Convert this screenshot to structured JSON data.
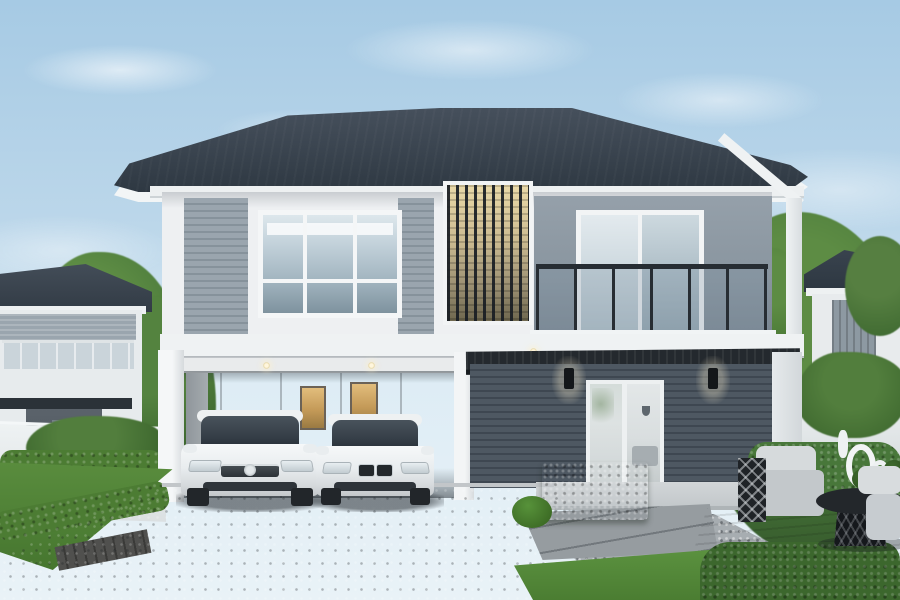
{
  "scene": {
    "type": "architectural-exterior-render",
    "description": "Daytime 3D rendering of a modern two-storey detached house in grey and white, with a dark hip roof, a vertical timber-slat feature, a glass-railed balcony, a double carport sheltering two white sedans, a dark horizontal-clad entry wall with twin sconces and glass doors, manicured lawns, trimmed hedges, a gravel-and-paver path, an outdoor lounge set on a wooden patio, neighbouring houses and trees on both sides under a lightly clouded blue sky.",
    "objects": [
      "sky",
      "clouds",
      "trees",
      "neighbor-house-left",
      "neighbor-house-right",
      "white-fence-left",
      "white-fence-right",
      "hip-roof",
      "upper-floor-siding",
      "picture-window",
      "vertical-slat-screen",
      "balcony-glass-railing",
      "sliding-door",
      "carport",
      "downlights",
      "warm-lit-windows",
      "white-sedan-toyota",
      "white-sedan-bmw",
      "dark-clad-wall",
      "black-awning",
      "wall-sconces",
      "glass-entry-doors",
      "porch-slab",
      "driveway",
      "lawns",
      "box-hedge",
      "hedge-ball",
      "gravel-path",
      "stone-pavers",
      "wood-patio",
      "outdoor-armchair",
      "lattice-side-table",
      "round-coffee-table",
      "white-ring-decor",
      "outdoor-cushions",
      "shrub-bed"
    ]
  },
  "colors": {
    "skyTop": "#a6cae4",
    "skyBot": "#ddecf5",
    "roof": "#39434e",
    "roofLight": "#46505c",
    "fascia": "#f2f5f6",
    "wallWhite": "#eef0f2",
    "sidingLight": "#9aa5ae",
    "sidingLine": "#86929b",
    "wallGray": "#89959f",
    "glow": "#ead9a8",
    "railDark": "#272d33",
    "awning": "#24292e",
    "darkWall": "#4e5862",
    "darkWallLine": "#3e4751",
    "carportWall": "#adb2b6",
    "grass": "#5a8d3e",
    "hedge": "#4c7c33",
    "hedgeLight": "#6fae4d",
    "tree": "#48773a",
    "treeLight": "#5d8c44",
    "treeDark": "#35582a",
    "drive": "#8f9499",
    "gravel": "#a7adb1",
    "carWhite": "#f6f8f9"
  }
}
